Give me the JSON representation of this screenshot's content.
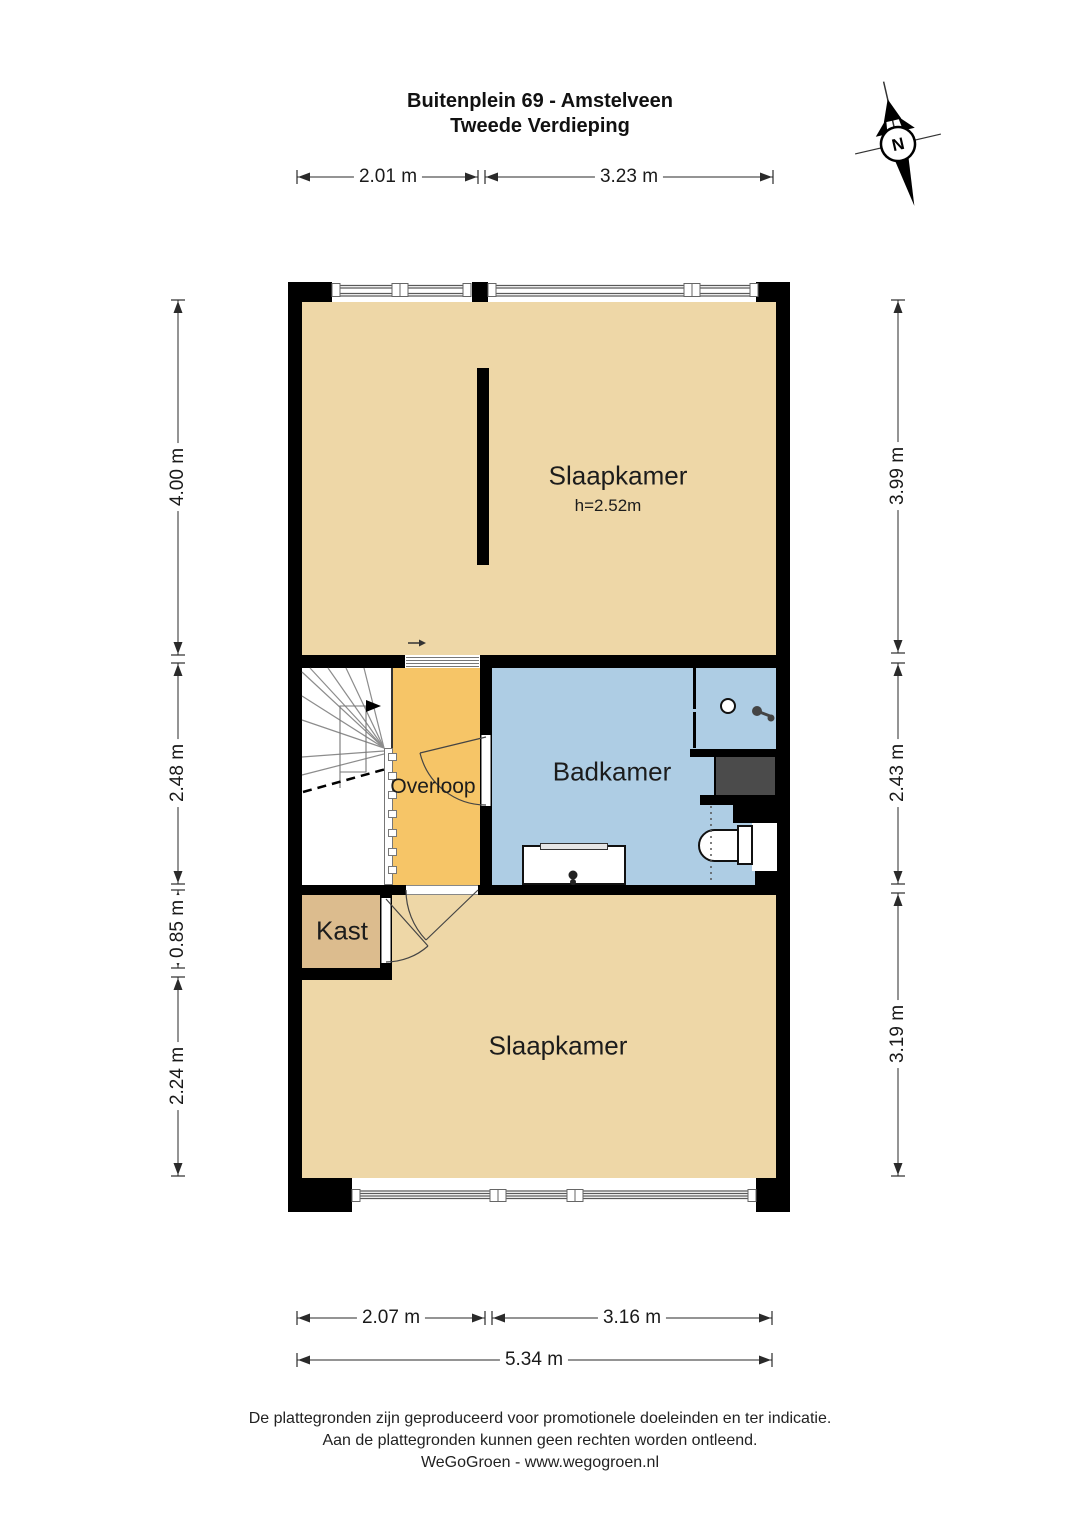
{
  "title": {
    "line1": "Buitenplein 69 - Amstelveen",
    "line2": "Tweede Verdieping"
  },
  "compass": {
    "label": "N"
  },
  "rooms": {
    "bedroom_top": {
      "label": "Slaapkamer",
      "ceiling_height": "h=2.52m"
    },
    "landing": {
      "label": "Overloop"
    },
    "bathroom": {
      "label": "Badkamer"
    },
    "closet": {
      "label": "Kast"
    },
    "bedroom_bottom": {
      "label": "Slaapkamer"
    }
  },
  "dimensions": {
    "top": [
      "2.01 m",
      "3.23 m"
    ],
    "left": [
      "4.00 m",
      "2.48 m",
      "0.85 m",
      "2.24 m"
    ],
    "right": [
      "3.99 m",
      "2.43 m",
      "3.19 m"
    ],
    "bottom_inner": [
      "2.07 m",
      "3.16 m"
    ],
    "bottom_total": "5.34 m"
  },
  "footer": {
    "line1": "De plattegronden zijn geproduceerd voor promotionele doeleinden en ter indicatie.",
    "line2": "Aan de plattegronden kunnen geen rechten worden ontleend.",
    "line3": "WeGoGroen - www.wegogroen.nl"
  },
  "colors": {
    "wall": "#000000",
    "bedroom_fill": "#EED7A7",
    "landing_fill": "#F6C567",
    "bathroom_fill": "#AECDE4",
    "closet_fill": "#DCBC8E",
    "shaft_fill": "#4B4B4B"
  }
}
